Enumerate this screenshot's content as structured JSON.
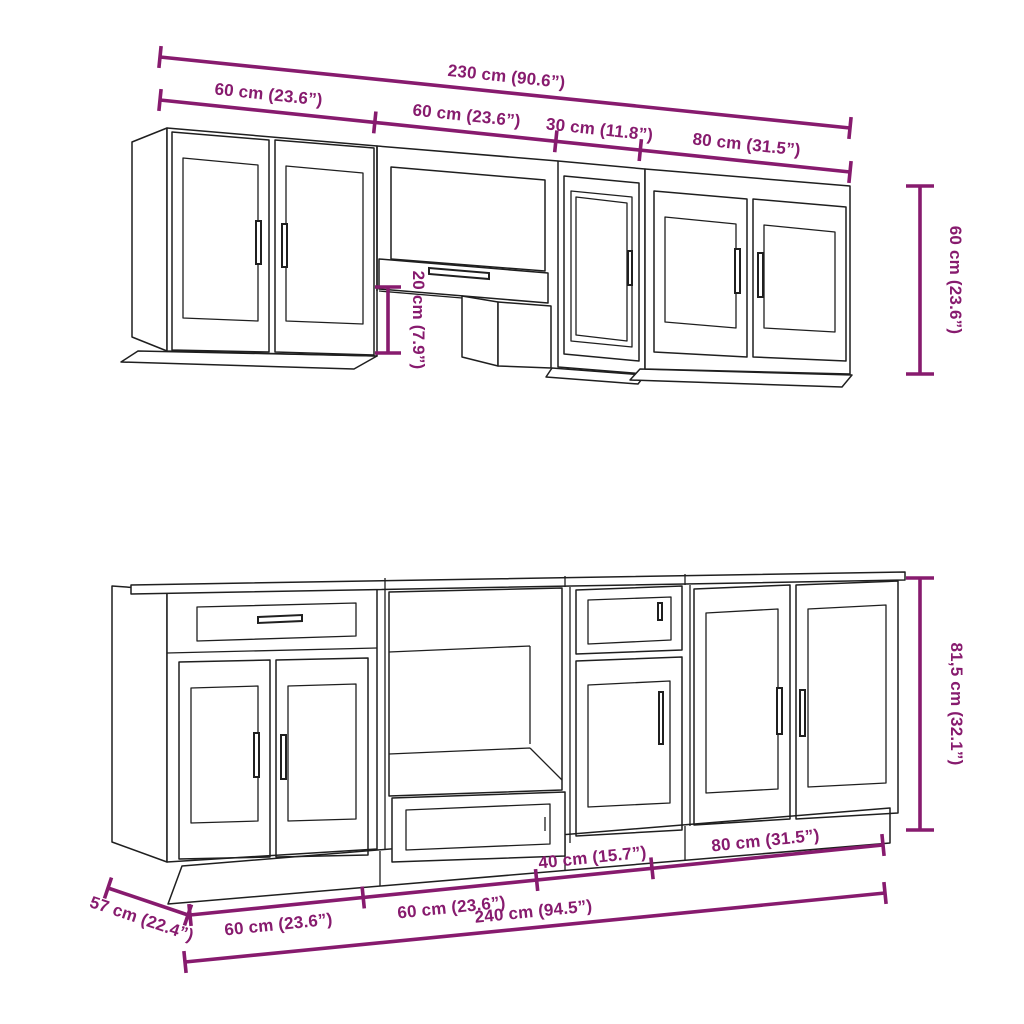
{
  "diagram": {
    "title": "Kitchen cabinet set dimension diagram",
    "colors": {
      "dimension": "#871B6E",
      "outline": "#1F1F1F",
      "background": "#FFFFFF"
    },
    "wall_row": {
      "total_width": "230 cm (90.6”)",
      "segment_widths": [
        "60 cm (23.6”)",
        "60 cm (23.6”)",
        "30 cm (11.8”)",
        "80 cm (31.5”)"
      ],
      "cabinet_height": "60 cm (23.6”)",
      "hood_box_height": "20 cm (7.9”)"
    },
    "base_row": {
      "total_width": "240 cm (94.5”)",
      "segment_widths": [
        "60 cm (23.6”)",
        "60 cm (23.6”)",
        "40 cm (15.7”)",
        "80 cm (31.5”)"
      ],
      "cabinet_height": "81,5 cm (32.1”)",
      "cabinet_depth": "57 cm (22.4”)"
    }
  }
}
